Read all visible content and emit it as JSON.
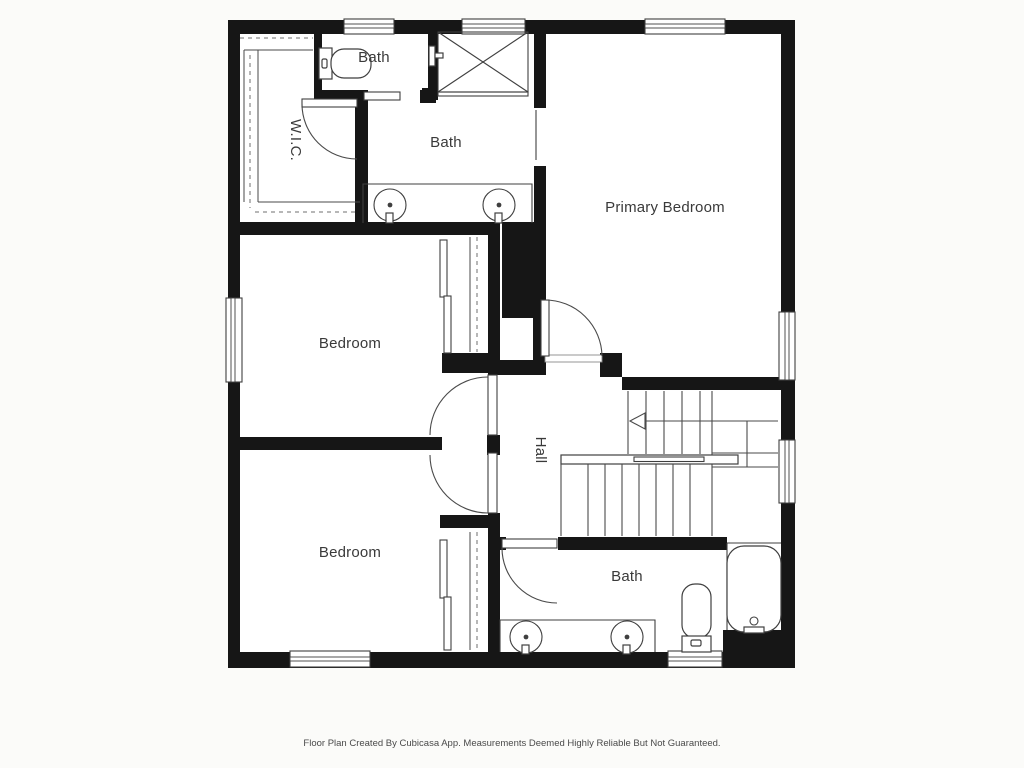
{
  "meta": {
    "app": "Cubicasa floor plan",
    "type": "floor-plan-image"
  },
  "colors": {
    "background": "#fbfbf9",
    "wall": "#161616",
    "line": "#3f3f3f",
    "label": "#3a3a3a",
    "footer_text": "#4a4a4a",
    "floor": "#ffffff"
  },
  "rooms": {
    "primary_bedroom": {
      "label": "Primary Bedroom"
    },
    "bath_ensuite_small": {
      "label": "Bath"
    },
    "bath_ensuite": {
      "label": "Bath"
    },
    "wic": {
      "label": "W.I.C."
    },
    "bedroom_middle": {
      "label": "Bedroom"
    },
    "bedroom_lower": {
      "label": "Bedroom"
    },
    "hall": {
      "label": "Hall"
    },
    "bath_lower": {
      "label": "Bath"
    }
  },
  "fixtures": {
    "icons": [
      "toilet-icon",
      "shower-icon",
      "sink-icon",
      "bathtub-icon",
      "staircase-icon",
      "stair-direction-arrow-icon",
      "door-swing-icon",
      "window-icon",
      "closet-rod-icon"
    ],
    "counts": {
      "bedrooms": 3,
      "baths": 3,
      "sinks": 4,
      "toilets": 2,
      "bathtubs": 1,
      "showers": 1,
      "closets": 3
    }
  },
  "footer": {
    "disclaimer": "Floor Plan Created By Cubicasa App. Measurements Deemed Highly Reliable But Not Guaranteed."
  }
}
